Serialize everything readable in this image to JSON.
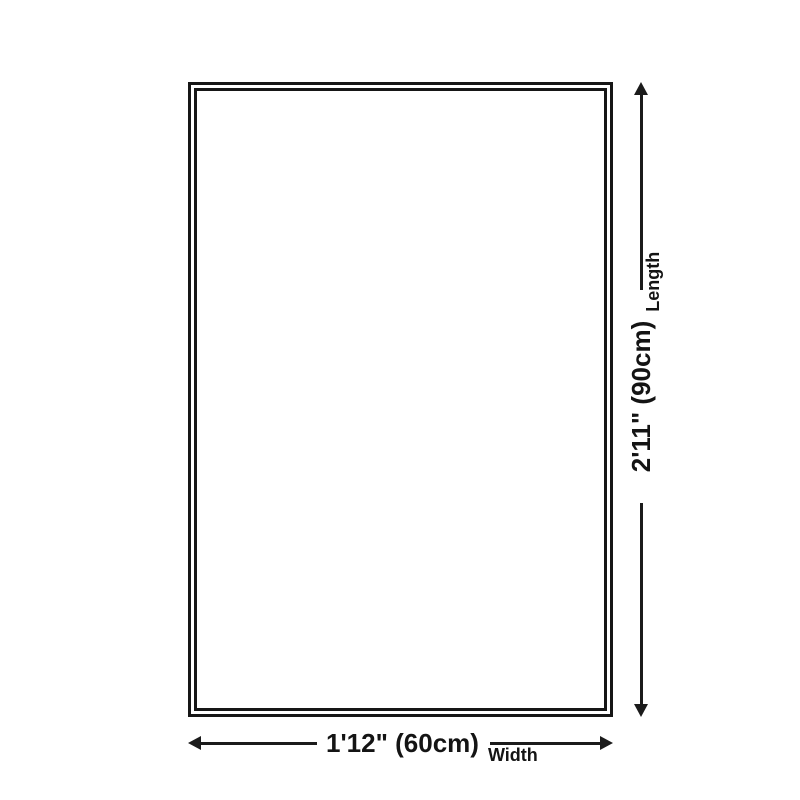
{
  "diagram": {
    "type": "product-size-diagram",
    "shape": "rectangle",
    "colors": {
      "background": "#ffffff",
      "line": "#1b1b1b",
      "text": "#141414",
      "rug_fill": "#ffffff"
    },
    "length_dimension": {
      "value": "2'11\" (90cm)",
      "label": "Length",
      "orientation": "vertical"
    },
    "width_dimension": {
      "value": "1'12\" (60cm)",
      "label": "Width",
      "orientation": "horizontal"
    }
  }
}
